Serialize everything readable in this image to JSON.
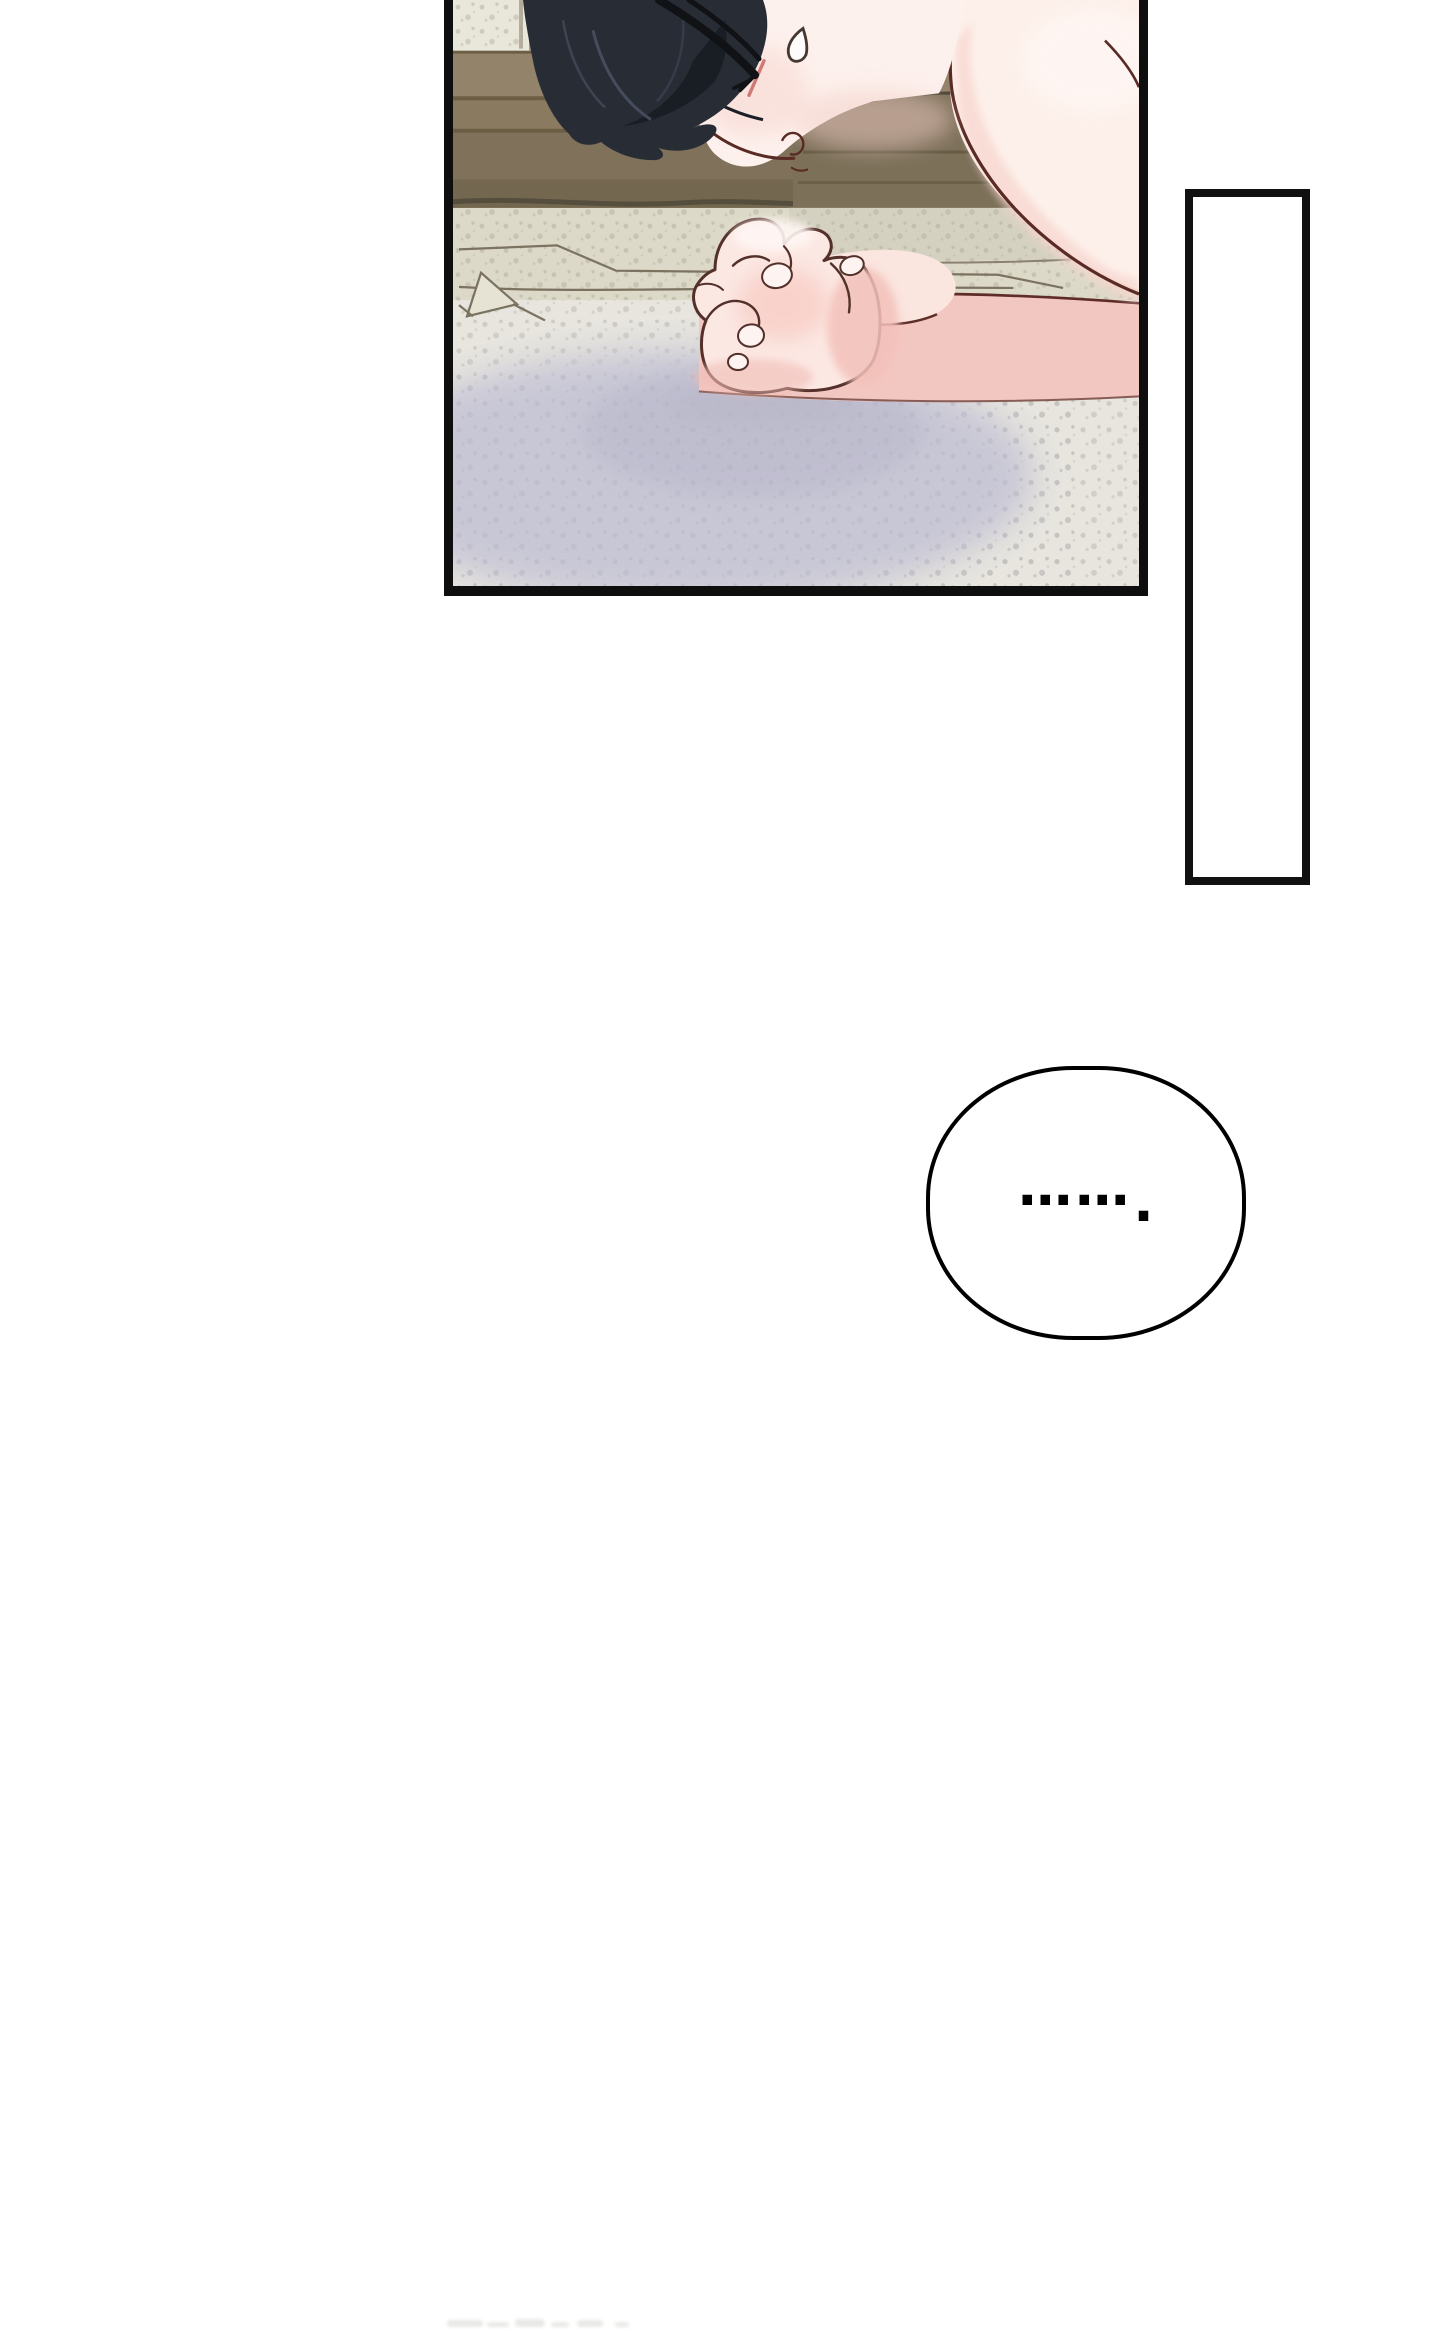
{
  "page": {
    "width_px": 1440,
    "height_px": 2329,
    "background_color": "#ffffff"
  },
  "comic": {
    "panel": {
      "border_color": "#0e0e0e",
      "scene": "character-lying-face-down-on-bed-hands-clasped",
      "palette": {
        "skin_light": "#fdf1ed",
        "skin_shadow": "#f6d4cd",
        "line_art": "#5a2a24",
        "hair": "#272c35",
        "hair_highlight": "#49505f",
        "wood_light": "#9b8a6d",
        "wood_mid": "#86775c",
        "wood_dark": "#6b5e45",
        "bedding_beige": "#ddd9c9",
        "bedding_speckle": "#b2ae9c",
        "blanket_gray": "#e7e5de",
        "blanket_speckle": "#b5b1a7",
        "shadow_lavender": "#c7c6d5",
        "blanket_pink": "#f3c7c1",
        "blush": "#cf7a74"
      }
    },
    "vertical_caption_box": {
      "text": "",
      "background": "#ffffff",
      "border_color": "#111111"
    },
    "speech_bubble": {
      "text": "…….",
      "dots": "……",
      "period": ".",
      "background": "#ffffff",
      "border_color": "#000000"
    },
    "next_panel_peek": {
      "color": "#e9e9e6"
    }
  }
}
